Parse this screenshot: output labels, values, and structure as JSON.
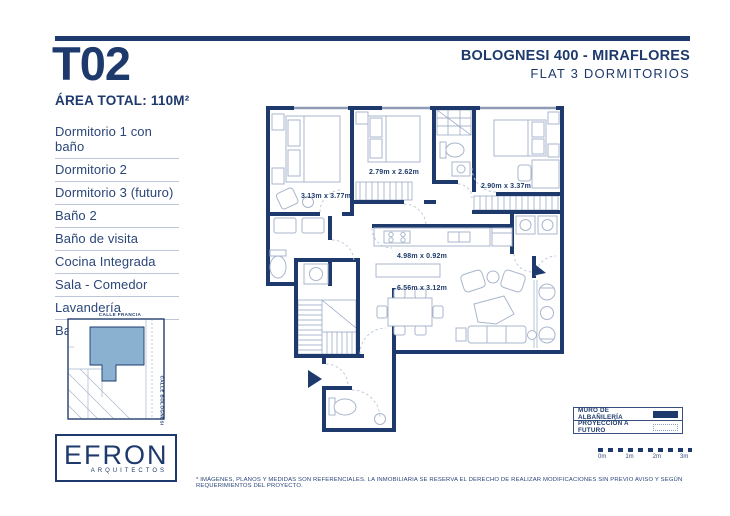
{
  "colors": {
    "navy": "#1e3a6c",
    "highlight": "#8bb1d0",
    "furniture": "#a9b6cc"
  },
  "header": {
    "unit": "T02",
    "area_label": "ÁREA TOTAL: 110M²",
    "project": "BOLOGNESI 400 - MIRAFLORES",
    "type": "FLAT 3 DORMITORIOS"
  },
  "room_list": [
    "Dormitorio 1 con baño",
    "Dormitorio 2",
    "Dormitorio 3 (futuro)",
    "Baño 2",
    "Baño de visita",
    "Cocina Integrada",
    "Sala - Comedor",
    "Lavandería",
    "Balcón"
  ],
  "site_map": {
    "street_top": "CALLE FRANCIA",
    "street_right": "CALLE BOLOGNESI"
  },
  "logo": {
    "name": "EFRON",
    "tagline": "ARQUITECTOS"
  },
  "plan": {
    "dimensions": [
      {
        "room": "dormitorio-1",
        "label": "3.13m x 3.77m"
      },
      {
        "room": "dormitorio-2",
        "label": "2.79m x 2.62m"
      },
      {
        "room": "dormitorio-3",
        "label": "2.90m x 3.37m"
      },
      {
        "room": "cocina",
        "label": "4.98m x 0.92m"
      },
      {
        "room": "sala-comedor",
        "label": "6.56m x 3.12m"
      }
    ]
  },
  "legend": {
    "items": [
      {
        "label": "MURO DE ALBAÑILERÍA",
        "swatch": "solid"
      },
      {
        "label": "PROYECCIÓN A FUTURO",
        "swatch": "dotted"
      }
    ]
  },
  "scale_bar": {
    "labels": [
      "0m",
      "1m",
      "2m",
      "3m"
    ]
  },
  "disclaimer": "* IMÁGENES, PLANOS Y MEDIDAS SON REFERENCIALES. LA INMOBILIARIA SE RESERVA EL DERECHO DE REALIZAR MODIFICACIONES SIN PREVIO AVISO Y SEGÚN REQUERIMIENTOS DEL PROYECTO."
}
